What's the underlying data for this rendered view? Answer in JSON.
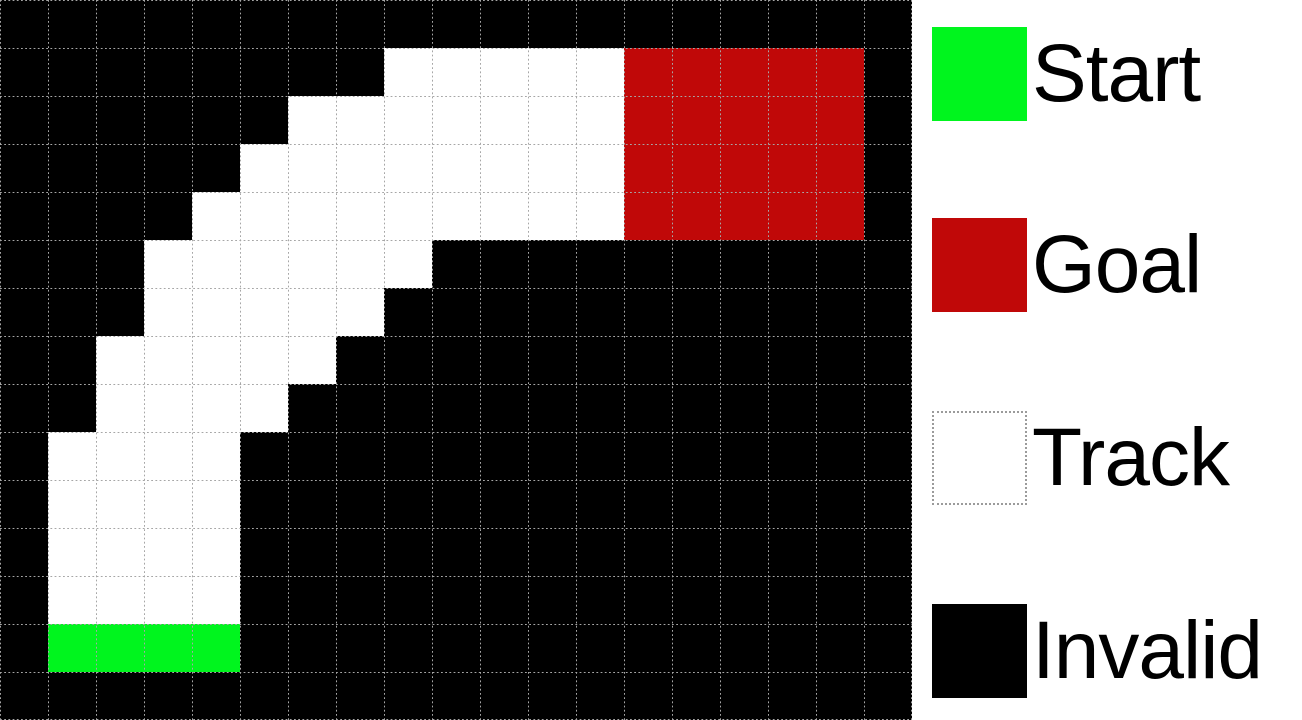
{
  "figure": {
    "title": "racetrack-gridworld",
    "grid": {
      "rows": 15,
      "cols": 19,
      "cell_size_px": 48,
      "cell_types": {
        "B": "invalid",
        "T": "track",
        "S": "start",
        "G": "goal"
      },
      "colors": {
        "invalid": "#000000",
        "track": "#ffffff",
        "start": "#00F51E",
        "goal": "#C00808",
        "gridline": "#a6a6a6"
      },
      "map": [
        "BBBBBBBBBBBBBBBBBBB",
        "BBBBBBBBTTTTTGGGGGB",
        "BBBBBBTTTTTTTGGGGGB",
        "BBBBBTTTTTTTTGGGGGB",
        "BBBBTTTTTTTTTGGGGGB",
        "BBBTTTTTTBBBBBBBBBB",
        "BBBTTTTTBBBBBBBBBBB",
        "BBTTTTTBBBBBBBBBBBB",
        "BBTTTTBBBBBBBBBBBBB",
        "BTTTTBBBBBBBBBBBBBB",
        "BTTTTBBBBBBBBBBBBBB",
        "BTTTTBBBBBBBBBBBBBB",
        "BTTTTBBBBBBBBBBBBBB",
        "BSSSSBBBBBBBBBBBBBB",
        "BBBBBBBBBBBBBBBBBBB"
      ]
    },
    "legend": {
      "items": [
        {
          "label": "Start",
          "type": "start",
          "color": "#00F51E",
          "dotted_border": false
        },
        {
          "label": "Goal",
          "type": "goal",
          "color": "#C00808",
          "dotted_border": false
        },
        {
          "label": "Track",
          "type": "track",
          "color": "#ffffff",
          "dotted_border": true
        },
        {
          "label": "Invalid",
          "type": "invalid",
          "color": "#000000",
          "dotted_border": false
        }
      ]
    }
  }
}
